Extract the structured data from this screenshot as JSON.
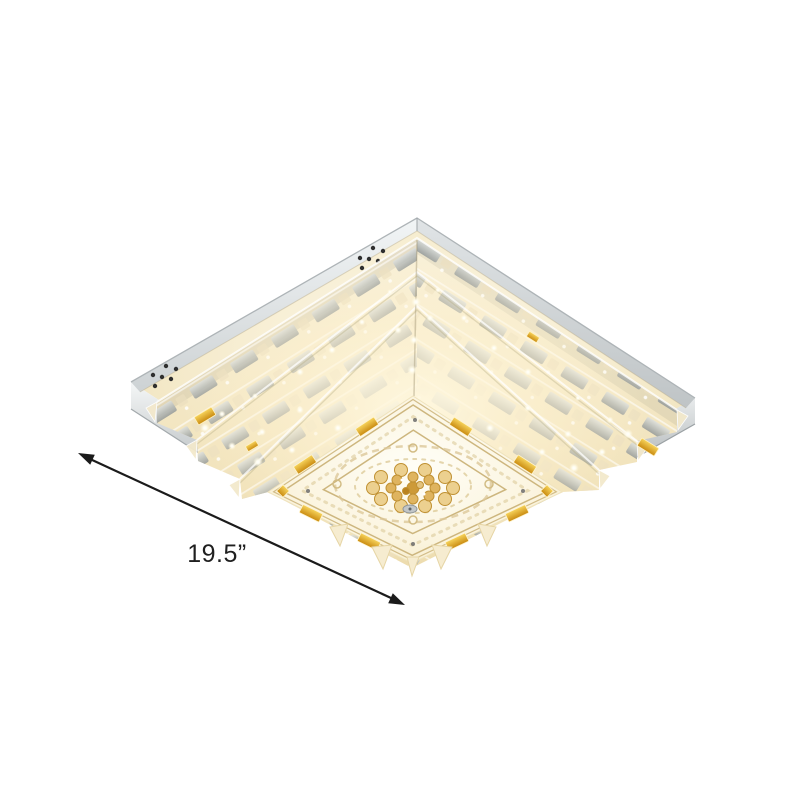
{
  "canvas": {
    "width": 800,
    "height": 800,
    "background": "#ffffff"
  },
  "product_photo": {
    "subject": "square-tiered-crystal-flush-mount-ceiling-light",
    "parts": [
      "chrome-canopy",
      "vent-holes",
      "crystal-tiers",
      "amber-accents",
      "ornate-panel",
      "crystal-flower-medallion"
    ]
  },
  "annotation": {
    "width_label": "19.5”"
  },
  "colors": {
    "canvas_bg": "#ffffff",
    "chrome_light": "#eef1f2",
    "chrome_mid": "#c8ccce",
    "chrome_dark": "#9aa0a3",
    "glow_warm": "#f9f0d6",
    "crystal_champagne": "#f1e3bd",
    "mirror_gray": "#a9afb2",
    "amber_accent": "#e2a81f",
    "panel_cream": "#fdf8e8",
    "gold_filigree": "#cdb67e",
    "arrow_color": "#1b1b1b",
    "label_color": "#1f1f1f",
    "vent_hole": "#2f2f2f"
  }
}
